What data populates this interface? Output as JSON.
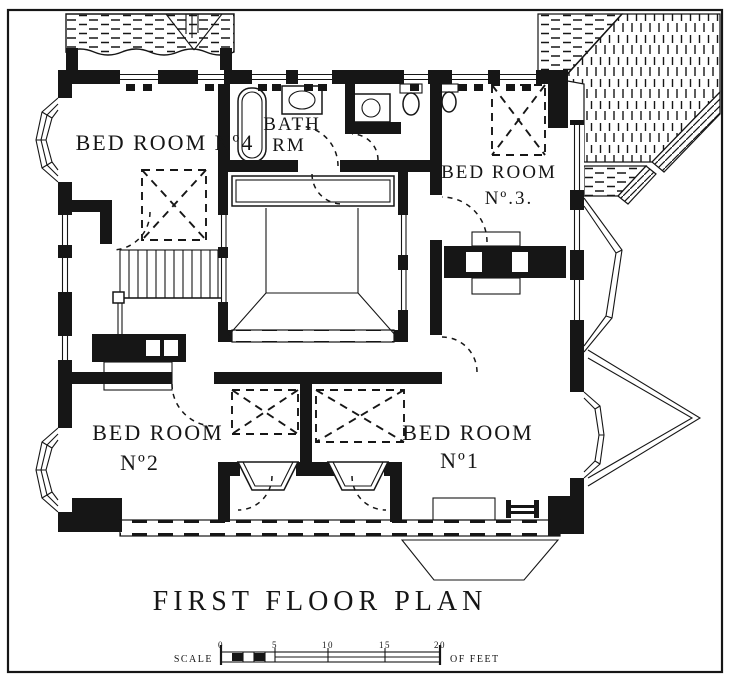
{
  "colors": {
    "ink": "#161616",
    "paper": "#ffffff"
  },
  "title": "FIRST FLOOR PLAN",
  "rooms": {
    "bedroom4": {
      "label": "BED ROOM Nº4"
    },
    "bath": {
      "line1": "BATH",
      "line2": "RM"
    },
    "bedroom3": {
      "line1": "BED ROOM",
      "line2": "Nº.3."
    },
    "bedroom2": {
      "line1": "BED ROOM",
      "line2": "Nº2"
    },
    "bedroom1": {
      "line1": "BED ROOM",
      "line2": "Nº1"
    }
  },
  "scale_bar": {
    "label": "SCALE",
    "units": "OF FEET",
    "ticks": [
      "0",
      "5",
      "10",
      "15",
      "20"
    ]
  }
}
